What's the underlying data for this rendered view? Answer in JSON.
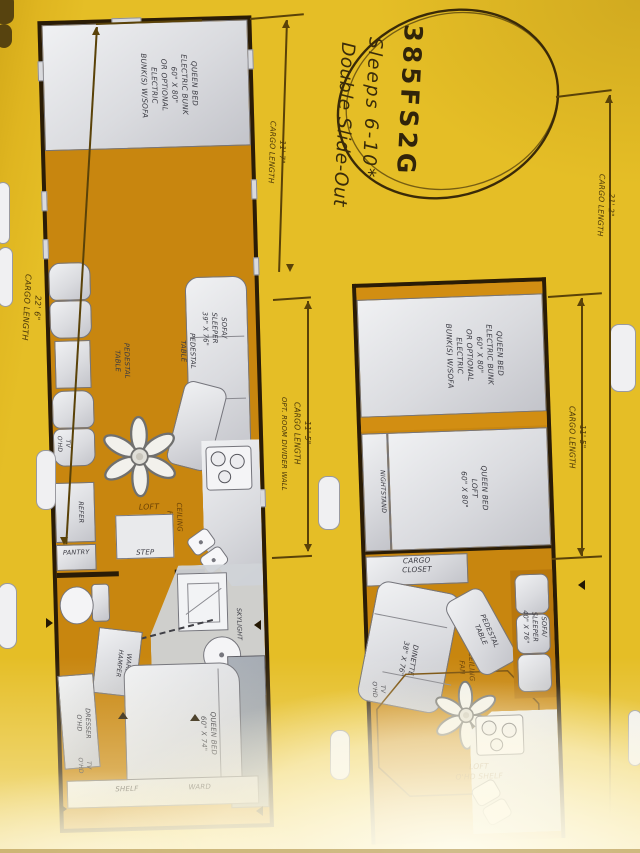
{
  "page": {
    "description": "Photographed RV toy-hauler brochure page (rotated 90°) showing two floor plans on yellow background"
  },
  "badge": {
    "model": "385FS2G",
    "sleeps": "Sleeps 6-10*",
    "slide": "Double Slide-Out"
  },
  "dimensions": {
    "left_total": "22' 6\"\nCARGO LENGTH",
    "left_rear": "11' 7\"\nCARGO LENGTH",
    "left_mid": "11' 5\"\nCARGO LENGTH",
    "divider_note": "OPT. ROOM DIVIDER WALL",
    "right_total": "21' 2\"\nCARGO LENGTH",
    "right_rear": "11' 5\"\nCARGO LENGTH"
  },
  "plan_left": {
    "labels": {
      "bunk_bed": "QUEEN BED\nELECTRIC BUNK\n60\" X 80\"\nOR OPTIONAL\nELECTRIC\nBUNK(S) W/SOFA",
      "pedestal_table_a": "PEDESTAL\nTABLE",
      "pedestal_table_b": "PEDESTAL\nTABLE",
      "sofa_sleeper": "SOFA/\nSLEEPER\n39\" X 76\"",
      "tv_ohd_living": "TV\nO'HD",
      "ceiling_fan": "CEILING\nFAN",
      "loft_shelf": "LOFT\nO'HD SHELF",
      "refer": "REFER",
      "pantry": "PANTRY",
      "step": "STEP",
      "skylight": "SKYLIGHT",
      "ward_hamper": "WARD/\nHAMPER",
      "dresser_ohd": "DRESSER\nO'HD",
      "tv_ohd_bedroom": "TV\nO'HD",
      "queen_bed": "QUEEN BED\n60\" X 74\"",
      "shelf": "SHELF",
      "ward": "WARD"
    }
  },
  "plan_right": {
    "labels": {
      "bunk_bed": "QUEEN BED\nELECTRIC BUNK\n60\" X 80\"\nOR OPTIONAL\nELECTRIC\nBUNK(S) W/SOFA",
      "nightstand": "NIGHTSTAND",
      "queen_loft": "QUEEN BED\nLOFT\n60\" X 80\"",
      "cargo_closet": "CARGO\nCLOSET",
      "dinette": "DINETTE\n38\" X 76\"",
      "tv_ohd": "TV\nO'HD",
      "ceiling_fan": "CEILING\nFAN",
      "pedestal_table": "PEDESTAL\nTABLE",
      "sofa_sleeper": "SOFA/\nSLEEPER\n40\" X 76\"",
      "loft_shelf": "LOFT\nO'HD SHELF"
    }
  },
  "colors": {
    "page_yellow": "#E5BE26",
    "floor_orange": "#C8860F",
    "slide_orange": "#D28E12",
    "wall_ink": "#2A1C06",
    "furniture_gray": "#D8D9DD",
    "label_ink": "#3A3A42",
    "floor_label_ink": "#6B4206",
    "dimension_ink": "#4A3608"
  }
}
